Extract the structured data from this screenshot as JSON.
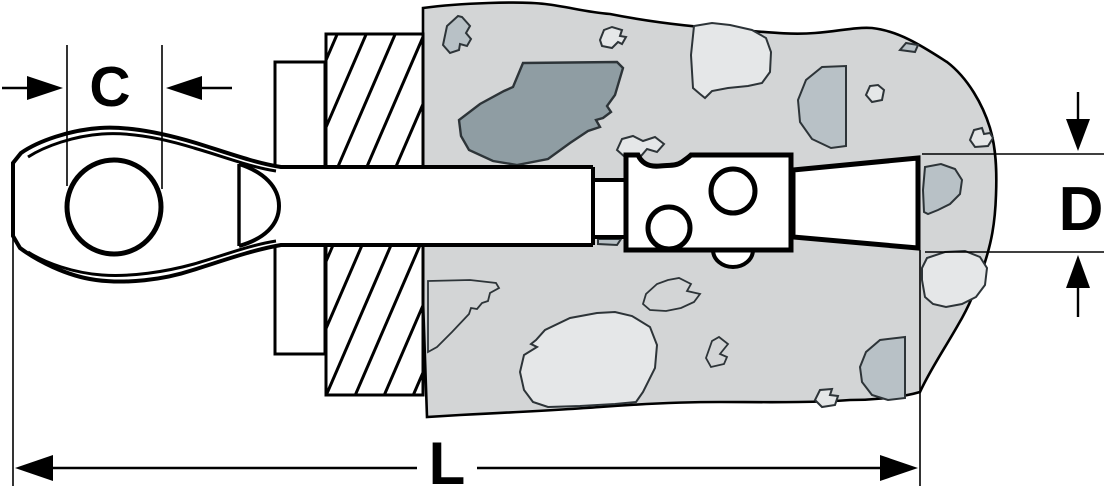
{
  "diagram": {
    "dimension_labels": {
      "eye_inner_width": "C",
      "embedment_diameter": "D",
      "overall_length": "L"
    },
    "colors": {
      "background": "#ffffff",
      "line": "#000000",
      "aggregate_outline": "#2d3438",
      "concrete_base": "#d3d5d6",
      "aggregate_light": "#e5e7e8",
      "aggregate_medium": "#b8c1c6",
      "aggregate_dark": "#8f9da3"
    }
  }
}
